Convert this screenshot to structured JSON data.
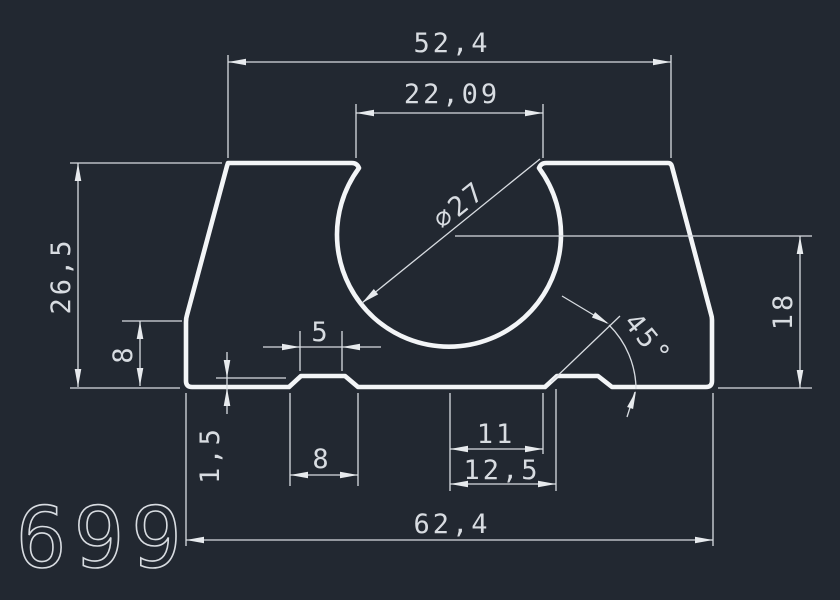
{
  "drawing": {
    "background": "#222831",
    "outline_color": "#f3f5f7",
    "dimension_color": "#d8dce1",
    "part_number": "699",
    "dimensions": {
      "top_width": "52,4",
      "opening_width": "22,09",
      "hole_diameter": "∅27",
      "overall_height": "26,5",
      "left_step_height": "8",
      "boss_top_width": "5",
      "boss_height": "1,5",
      "boss_base_width": "8",
      "slot_width_inner": "11",
      "slot_width_outer": "12,5",
      "bottom_width": "62,4",
      "right_height": "18",
      "chamfer_angle": "45°"
    }
  }
}
